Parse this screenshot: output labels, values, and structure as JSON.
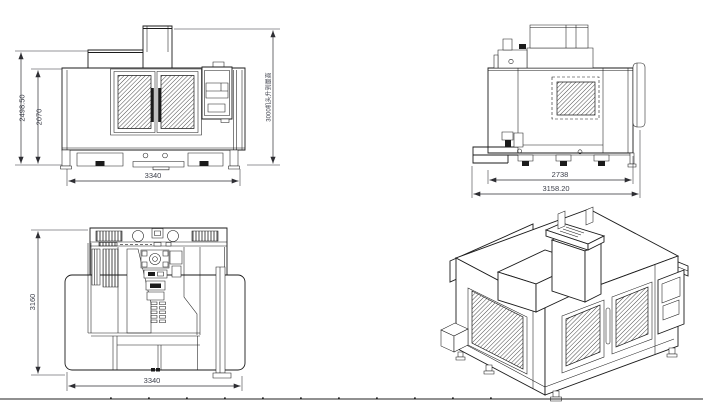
{
  "drawing": {
    "colors": {
      "line": "#1b1b1b",
      "background": "#ffffff",
      "dim_text": "#3c3f4a"
    },
    "views": {
      "front": {
        "dim_overall_height": "2498.50",
        "dim_enclosure_height": "2070",
        "dim_overall_width": "3340",
        "dim_head_raised_note": "3000机头升到最高"
      },
      "side": {
        "dim_body_width": "2738",
        "dim_overall_width": "3158.20"
      },
      "plan": {
        "dim_overall_depth": "3160",
        "dim_overall_width": "3340"
      }
    }
  }
}
